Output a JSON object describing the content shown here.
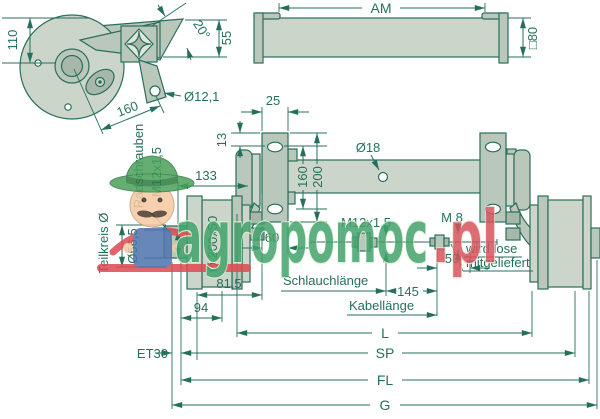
{
  "watermark": {
    "brand_green": "agropomoc",
    "brand_red": ".pl",
    "green_hex": "#42a26c",
    "red_hex": "#d6545c"
  },
  "colors": {
    "line": "#25705c",
    "part_fill_light": "#ccd5ca",
    "part_fill_mid": "#bac7bb",
    "part_fill_dark": "#a7b7aa",
    "background": "#ffffff"
  },
  "detail_view": {
    "height": "110",
    "angle": "20°",
    "offset": "55",
    "length": "160",
    "hole": "Ø12,1"
  },
  "tube_view": {
    "length_label": "AM",
    "section": "□80"
  },
  "main_view": {
    "plate_width": "25",
    "hole_edge": "13",
    "lever": "133",
    "hole_spacing": "160",
    "plate_height": "200",
    "hole_dia": "Ø18",
    "studs_label": "Radschrauben",
    "studs_thread": "M12x1,5",
    "bolt_circle_label": "Teilkreis Ø",
    "hub_bore": "Ø56,5",
    "drum": "Ø 200x50",
    "seat": "60",
    "flange_offset": "81,5",
    "hub_width": "94",
    "hose_thread": "M12x1,5",
    "cable_thread": "M 8",
    "loose_len": "50",
    "diff_len": "145",
    "loose_note_1": "wird lose",
    "loose_note_2": "mitgeliefert",
    "hose_label": "Schlauchlänge",
    "cable_label": "Kabellänge",
    "offset_label": "ET30",
    "dim_l": "L",
    "dim_sp": "SP",
    "dim_fl": "FL",
    "dim_g": "G"
  }
}
